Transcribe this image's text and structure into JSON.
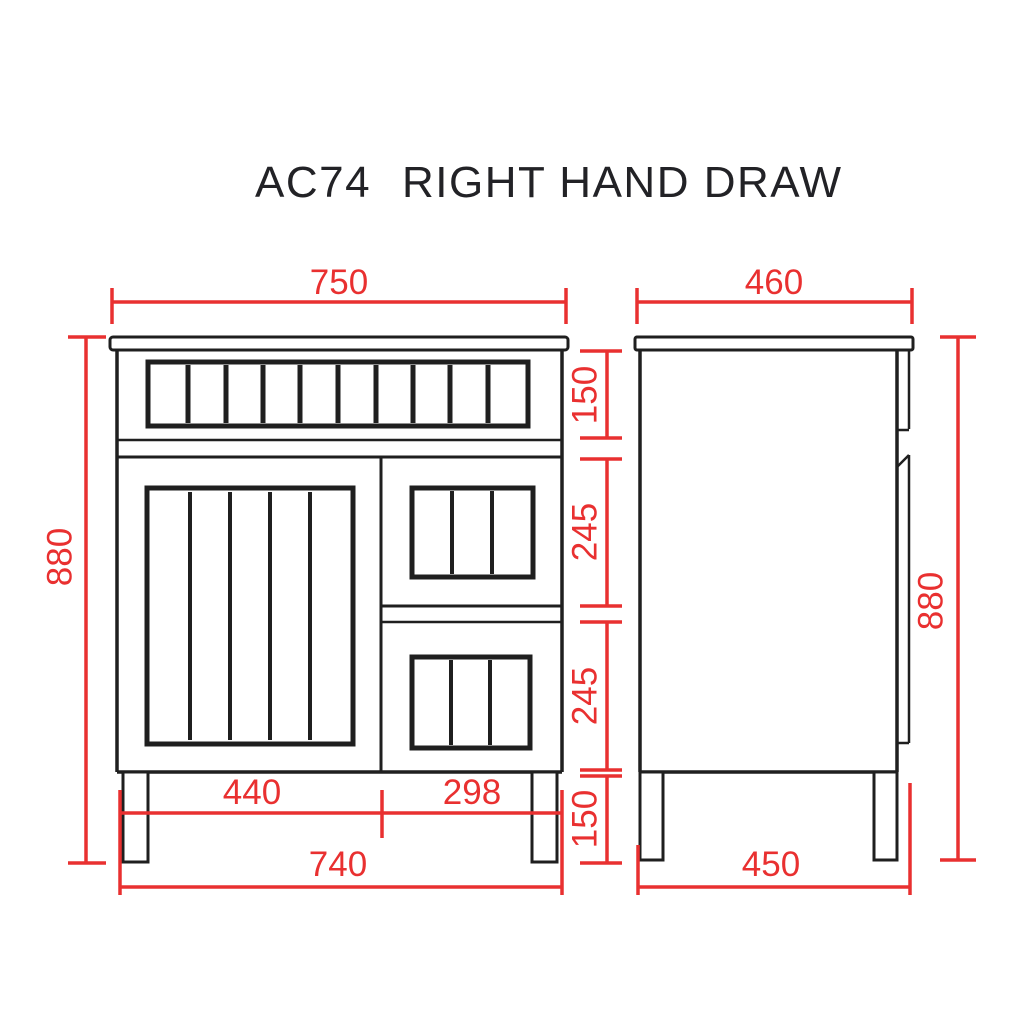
{
  "title": {
    "model": "AC74",
    "name": "RIGHT HAND DRAW"
  },
  "colors": {
    "line": "#1f1f1f",
    "dimension": "#e93030",
    "background": "#ffffff"
  },
  "dims": {
    "front": {
      "width": "750",
      "height": "880",
      "top_section": "150",
      "upper_drawer": "245",
      "lower_drawer": "245",
      "legs": "150",
      "door_width": "440",
      "drawer_width": "298",
      "base_width": "740"
    },
    "side": {
      "depth": "460",
      "height": "880",
      "base_depth": "450"
    }
  }
}
